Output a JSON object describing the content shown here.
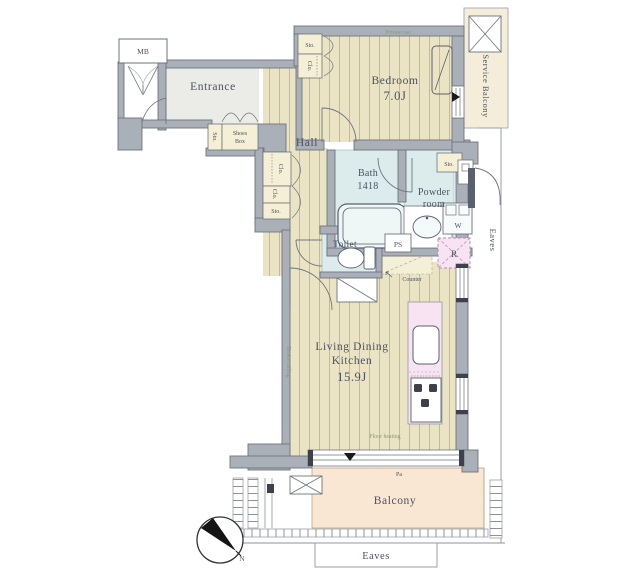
{
  "plan": {
    "rooms": {
      "entrance": "Entrance",
      "hall": "Hall",
      "bedroom": {
        "name": "Bedroom",
        "area": "7.0J"
      },
      "bath": {
        "name": "Bath",
        "size": "1418"
      },
      "powder": {
        "line1": "Powder",
        "line2": "room"
      },
      "toilet": "Toilet",
      "ldk": {
        "line1": "Living Dining",
        "line2": "Kitchen",
        "area": "15.9J"
      },
      "balcony": "Balcony",
      "service_balcony": "Service Balcony"
    },
    "labels": {
      "mb": "MB",
      "sto": "Sto.",
      "clo": "Clo.",
      "shoes_line1": "Shoes",
      "shoes_line2": "Box",
      "ps": "PS",
      "counter": "Counter",
      "washer": "W",
      "fridge": "R",
      "pa": "Pa",
      "eaves": "Eaves",
      "north": "N"
    },
    "annotations": {
      "bedroom_top": "Private use",
      "ldk_left": "Down ceiling",
      "floor_heating": "Floor heating"
    },
    "colors": {
      "wall": "#aab0b8",
      "wood_floor": "#eae4c5",
      "wet_floor": "#dcecec",
      "closet": "#f5f0d5",
      "balcony": "#f9e6d3",
      "service_balcony": "#f4edda",
      "kitchen_pink": "#f7e3f1",
      "text": "#4b5263"
    }
  }
}
